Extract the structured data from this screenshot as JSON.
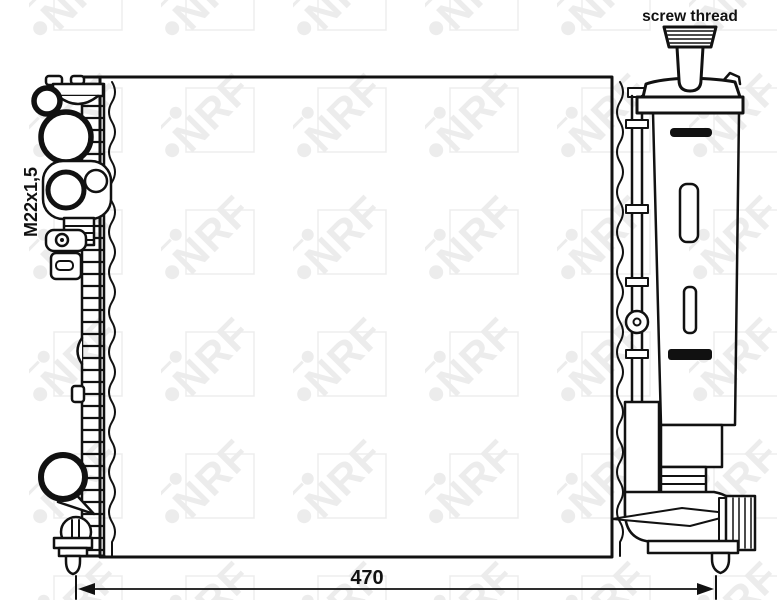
{
  "drawing": {
    "labels": {
      "screw_thread": "screw thread",
      "thread_size": "M22x1,5",
      "width_dimension": "470"
    },
    "watermark": {
      "text": "NRF",
      "color": "#ececec"
    },
    "line_color": "#111111",
    "background_color": "#ffffff"
  }
}
